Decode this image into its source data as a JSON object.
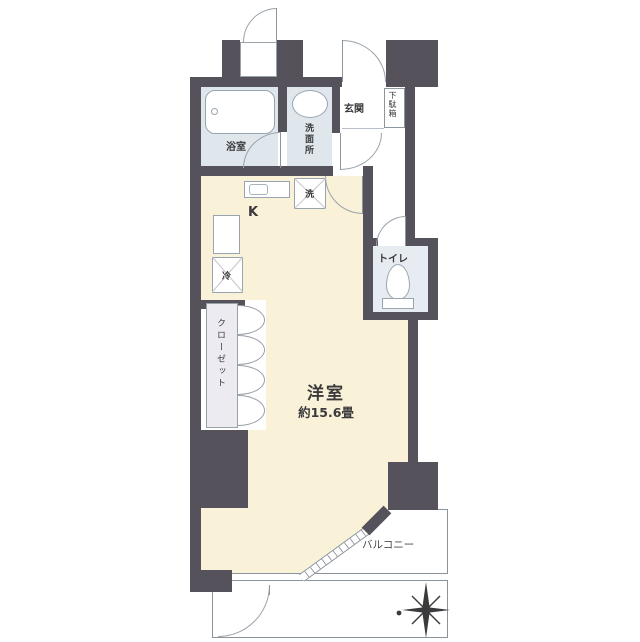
{
  "floorplan": {
    "main_room": {
      "name": "洋室",
      "size": "約15.6畳"
    },
    "kitchen": {
      "label": "K"
    },
    "bathroom": {
      "label": "浴室"
    },
    "washroom": {
      "label": "洗面所"
    },
    "toilet": {
      "label": "トイレ"
    },
    "closet": {
      "label": "クローゼット"
    },
    "entrance": {
      "label": "玄関"
    },
    "shoe_cabinet": {
      "label": "下駄箱"
    },
    "balcony": {
      "label": "バルコニー"
    },
    "appliances": {
      "refrigerator": "冷",
      "washing_machine": "洗"
    },
    "colors": {
      "wall": "#56525c",
      "room_floor": "#faf1d9",
      "wet_area_floor": "#dfe6ec",
      "closet_floor": "#ecebf2",
      "outline": "#8a949c"
    }
  }
}
